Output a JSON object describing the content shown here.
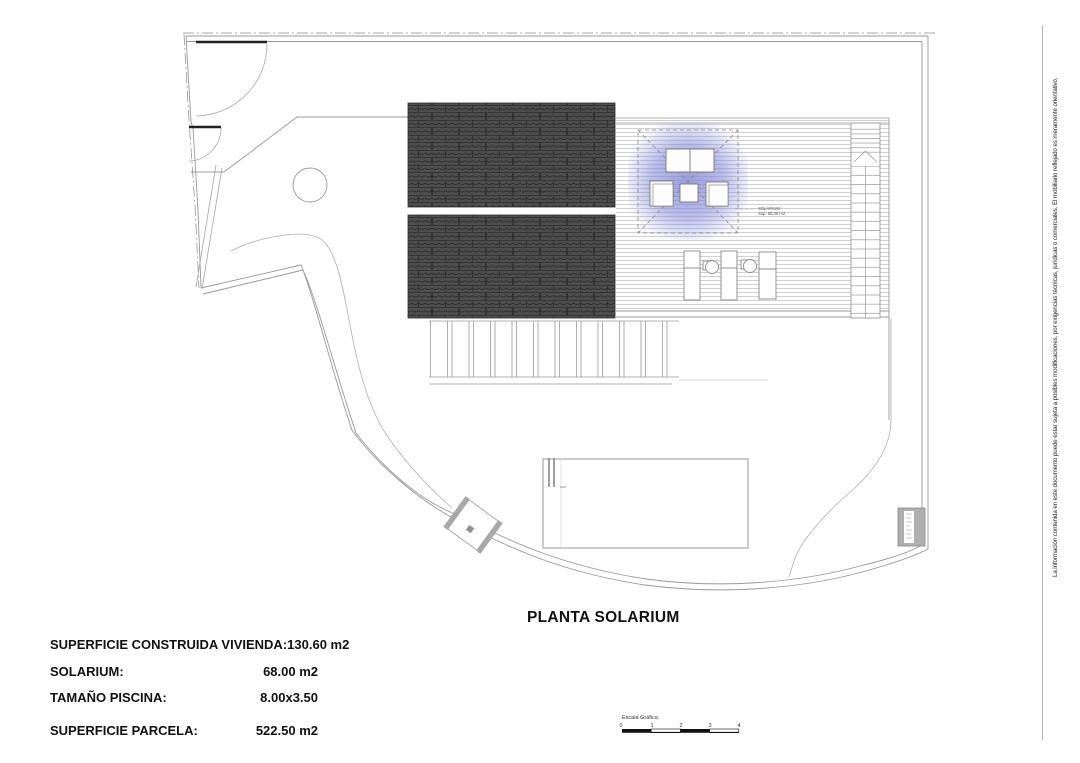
{
  "document": {
    "title": "PLANTA SOLARIUM",
    "disclaimer": "La información contenida en este documento puede estar sujeta a posibles modificaciones, por exigencias técnicas, jurídicas o comerciales. El mobiliario reflejado es meramente orientativo."
  },
  "plan": {
    "solarium_label_line1": "SOLARIUM",
    "solarium_label_line2": "Sup. 68.00 m2",
    "colors": {
      "roof_base": "#4d4d4d",
      "roof_line": "#2d2d2d",
      "deck_line": "#c5c5c5",
      "boundary": "#999999",
      "glow": "#8087d8"
    }
  },
  "summary": {
    "rows": [
      {
        "label": "SUPERFICIE CONSTRUIDA VIVIENDA:",
        "value": "130.60 m2"
      },
      {
        "label": "SOLARIUM:",
        "value": "68.00 m2"
      },
      {
        "label": "TAMAÑO PISCINA:",
        "value": "8.00x3.50"
      },
      {
        "label": "SUPERFICIE PARCELA:",
        "value": "522.50 m2"
      }
    ]
  },
  "scale_bar": {
    "label": "Escala Gráfica",
    "ticks": [
      "0",
      "1",
      "2",
      "3",
      "4"
    ]
  }
}
